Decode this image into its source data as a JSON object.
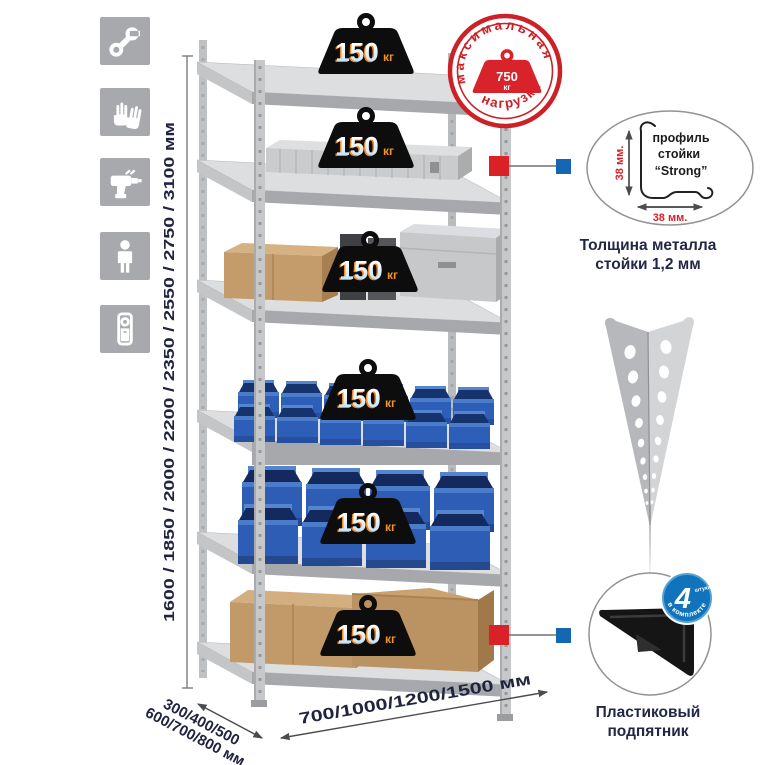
{
  "icons": [
    {
      "name": "wrench"
    },
    {
      "name": "work-gloves"
    },
    {
      "name": "drill"
    },
    {
      "name": "person-height"
    },
    {
      "name": "level-tool"
    }
  ],
  "rack": {
    "weights": [
      {
        "value": "150",
        "unit": "кг"
      },
      {
        "value": "150",
        "unit": "кг"
      },
      {
        "value": "150",
        "unit": "кг"
      },
      {
        "value": "150",
        "unit": "кг"
      },
      {
        "value": "150",
        "unit": "кг"
      },
      {
        "value": "150",
        "unit": "кг"
      }
    ],
    "stamp": {
      "arc_top": "максимальная",
      "arc_bottom": "нагрузка",
      "value": "750",
      "unit": "кг"
    }
  },
  "dimensions": {
    "height": "1600 / 1850 / 2000 / 2200 / 2350 / 2550 / 2750 / 3100 мм",
    "depth_line1": "300/400/500",
    "depth_line2": "600/700/800 мм",
    "width": "700/1000/1200/1500 мм"
  },
  "profile_detail": {
    "label_line1": "профиль",
    "label_line2": "стойки",
    "label_line3": "“Strong”",
    "dim_vertical": "38 мм.",
    "dim_horizontal": "38 мм.",
    "caption_line1": "Толщина металла",
    "caption_line2": "стойки 1,2 мм"
  },
  "foot_detail": {
    "badge_value": "4",
    "badge_unit": "штуки",
    "badge_arc": "в комплекте",
    "caption_line1": "Пластиковый",
    "caption_line2": "подпятник"
  },
  "colors": {
    "accent_red": "#cc2127",
    "accent_blue": "#1173bb",
    "metal": "#c6c8ca",
    "bin_blue": "#2d5db5",
    "cardboard": "#c49c6c",
    "weight_black": "#0d0d0d",
    "unit_orange": "#f6921e",
    "text_navy": "#20243e"
  }
}
